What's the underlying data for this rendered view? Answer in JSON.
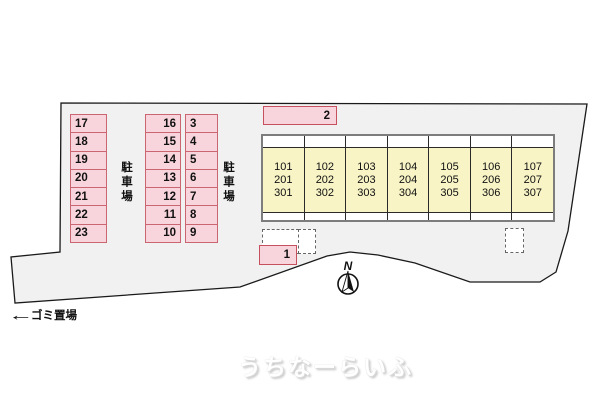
{
  "colors": {
    "site_fill": "#f1f1f1",
    "site_border": "#1a1a1a",
    "parking_fill": "#f8d5dc",
    "parking_border": "#c96672",
    "building_unit_fill": "#f8f4c6",
    "building_border": "#7d7d7d"
  },
  "parking": {
    "area_label_left": "駐車場",
    "area_label_right": "駐車場",
    "left_column": [
      "17",
      "18",
      "19",
      "20",
      "21",
      "22",
      "23"
    ],
    "middle_column": [
      "16",
      "15",
      "14",
      "13",
      "12",
      "11",
      "10"
    ],
    "right_column": [
      "3",
      "4",
      "5",
      "6",
      "7",
      "8",
      "9"
    ],
    "space_2": "2",
    "space_1": "1"
  },
  "building": {
    "units": [
      "101\n201\n301",
      "102\n202\n302",
      "103\n203\n303",
      "104\n204\n304",
      "105\n205\n305",
      "106\n206\n306",
      "107\n207\n307"
    ]
  },
  "compass": {
    "label": "N"
  },
  "garbage": {
    "arrow": "←",
    "label": "ゴミ置場"
  },
  "watermark": {
    "text": "うちなーらいふ"
  }
}
